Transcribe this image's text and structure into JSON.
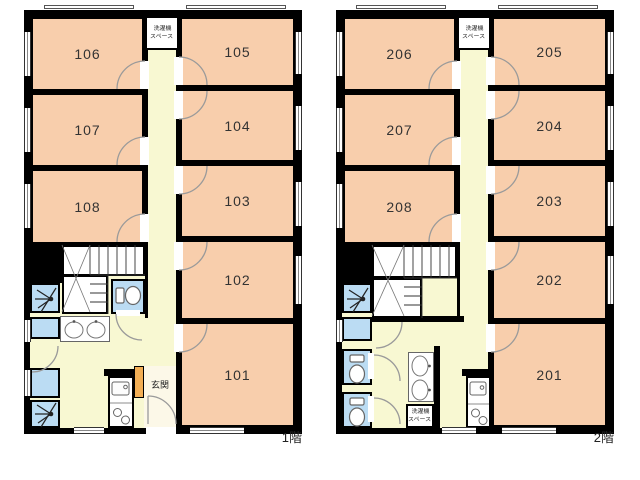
{
  "title": "apartment floor plans",
  "colors": {
    "room_fill": "#f8ceac",
    "hall_fill": "#f8f8d2",
    "wet_fill": "#bbdcf3",
    "entrance_fill": "#fcf8e8",
    "accent_orange": "#f2ae55",
    "wall": "#000000",
    "arc": "#9a9a9a"
  },
  "floor1": {
    "floor_label": "1階",
    "rooms": {
      "101": "101",
      "102": "102",
      "103": "103",
      "104": "104",
      "105": "105",
      "106": "106",
      "107": "107",
      "108": "108"
    },
    "laundry_top": [
      "洗濯機",
      "スペース"
    ],
    "entrance_label": "玄関"
  },
  "floor2": {
    "floor_label": "2階",
    "rooms": {
      "201": "201",
      "202": "202",
      "203": "203",
      "204": "204",
      "205": "205",
      "206": "206",
      "207": "207",
      "208": "208"
    },
    "laundry_top": [
      "洗濯機",
      "スペース"
    ],
    "laundry_bottom": [
      "洗濯機",
      "スペース"
    ]
  },
  "icons": {
    "shower-icon": "spray-fan",
    "toilet-icon": "tank-and-bowl",
    "washbasin-icon": "oval-basin-with-faucet",
    "kitchen-sink-icon": "rect-with-faucet",
    "stove-icon": "two-burner-circles",
    "laundry-x-icon": "diagonal-cross-box",
    "stairs-icon": "step-lines",
    "door-arc-icon": "quarter-circle-swing",
    "window-icon": "double-line-gap"
  }
}
